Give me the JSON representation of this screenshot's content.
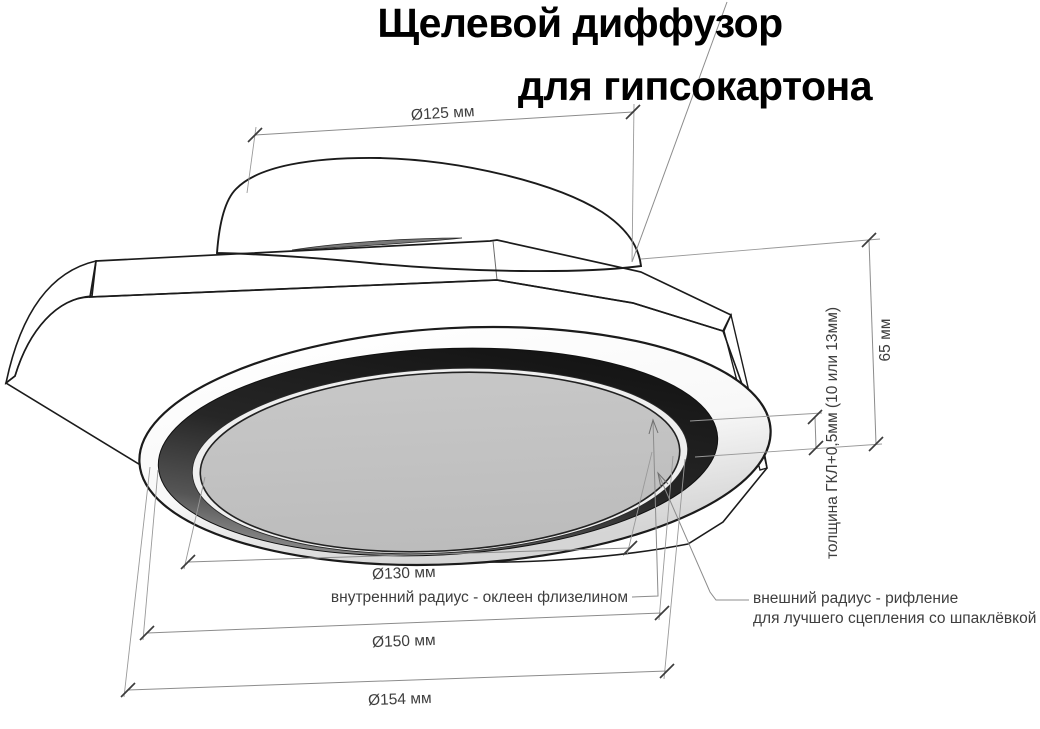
{
  "title": {
    "line1": "Щелевой диффузор",
    "line2": "для гипсокартона"
  },
  "dimensions": {
    "duct_diameter": {
      "label": "Ø125 мм"
    },
    "inner_diameter": {
      "label": "Ø130 мм"
    },
    "outer_diameter": {
      "label": "Ø150 мм"
    },
    "overall_diameter": {
      "label": "Ø154 мм"
    },
    "height": {
      "label": "65 мм"
    },
    "plate_thickness": {
      "label": "толщина ГКЛ+0,5мм (10 или 13мм)"
    }
  },
  "annotations": {
    "inner_radius": {
      "label": "внутренний радиус - оклеен флизелином"
    },
    "outer_radius": {
      "line1": "внешний радиус - рифление",
      "line2": "для лучшего сцепления со шпаклёвкой"
    }
  },
  "colors": {
    "background": "#ffffff",
    "outline": "#1b1b1b",
    "dimension_line": "#8c8c8c",
    "dimension_text": "#3e3e3e",
    "title_text": "#000000",
    "plate_gray": "#c5c5c5",
    "bevel_gray": "#9b9b9b",
    "sliver_gray": "#787878",
    "slot_dark": "#262626",
    "panel_gray": "#c2c2c2"
  }
}
